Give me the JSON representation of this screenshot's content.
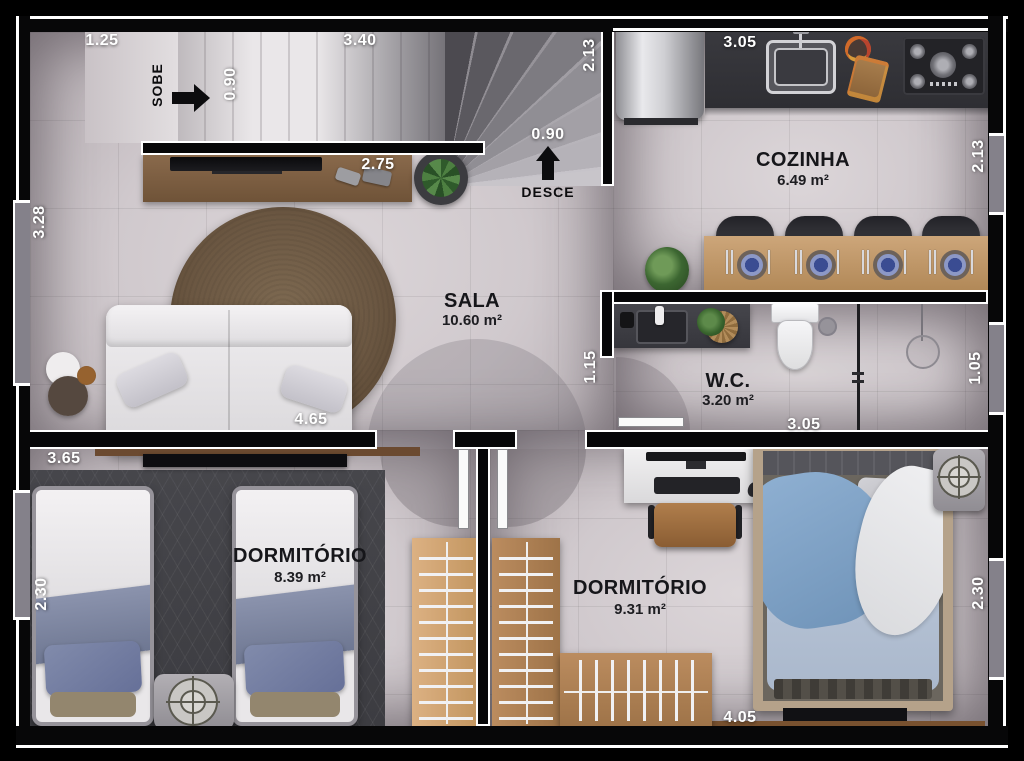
{
  "plan": {
    "rooms": {
      "sala": {
        "name": "SALA",
        "area": "10.60 m²"
      },
      "cozinha": {
        "name": "COZINHA",
        "area": "6.49 m²"
      },
      "wc": {
        "name": "W.C.",
        "area": "3.20 m²"
      },
      "dorm1": {
        "name": "DORMITÓRIO",
        "area": "8.39 m²"
      },
      "dorm2": {
        "name": "DORMITÓRIO",
        "area": "9.31 m²"
      }
    },
    "stair_labels": {
      "up": "SOBE",
      "down": "DESCE"
    },
    "dimensions": {
      "top_left": "1.25",
      "top_stairs": "3.40",
      "stair_width": "0.90",
      "stair_depth": "2.13",
      "kitchen_top": "3.05",
      "left_height": "3.28",
      "tv_wall": "2.75",
      "stair_exit": "0.90",
      "kitchen_right": "2.13",
      "sala_width": "4.65",
      "hall_width": "1.15",
      "wc_width": "3.05",
      "wc_right": "1.05",
      "dorm1_top": "3.65",
      "dorm1_left": "2.30",
      "dorm2_right": "2.30",
      "dorm2_bottom": "4.05"
    },
    "colors": {
      "wall": "#070708",
      "floor": "#d0c9cd",
      "wood": "#c49a6c",
      "bed_blue": "#8fb0d2"
    }
  }
}
